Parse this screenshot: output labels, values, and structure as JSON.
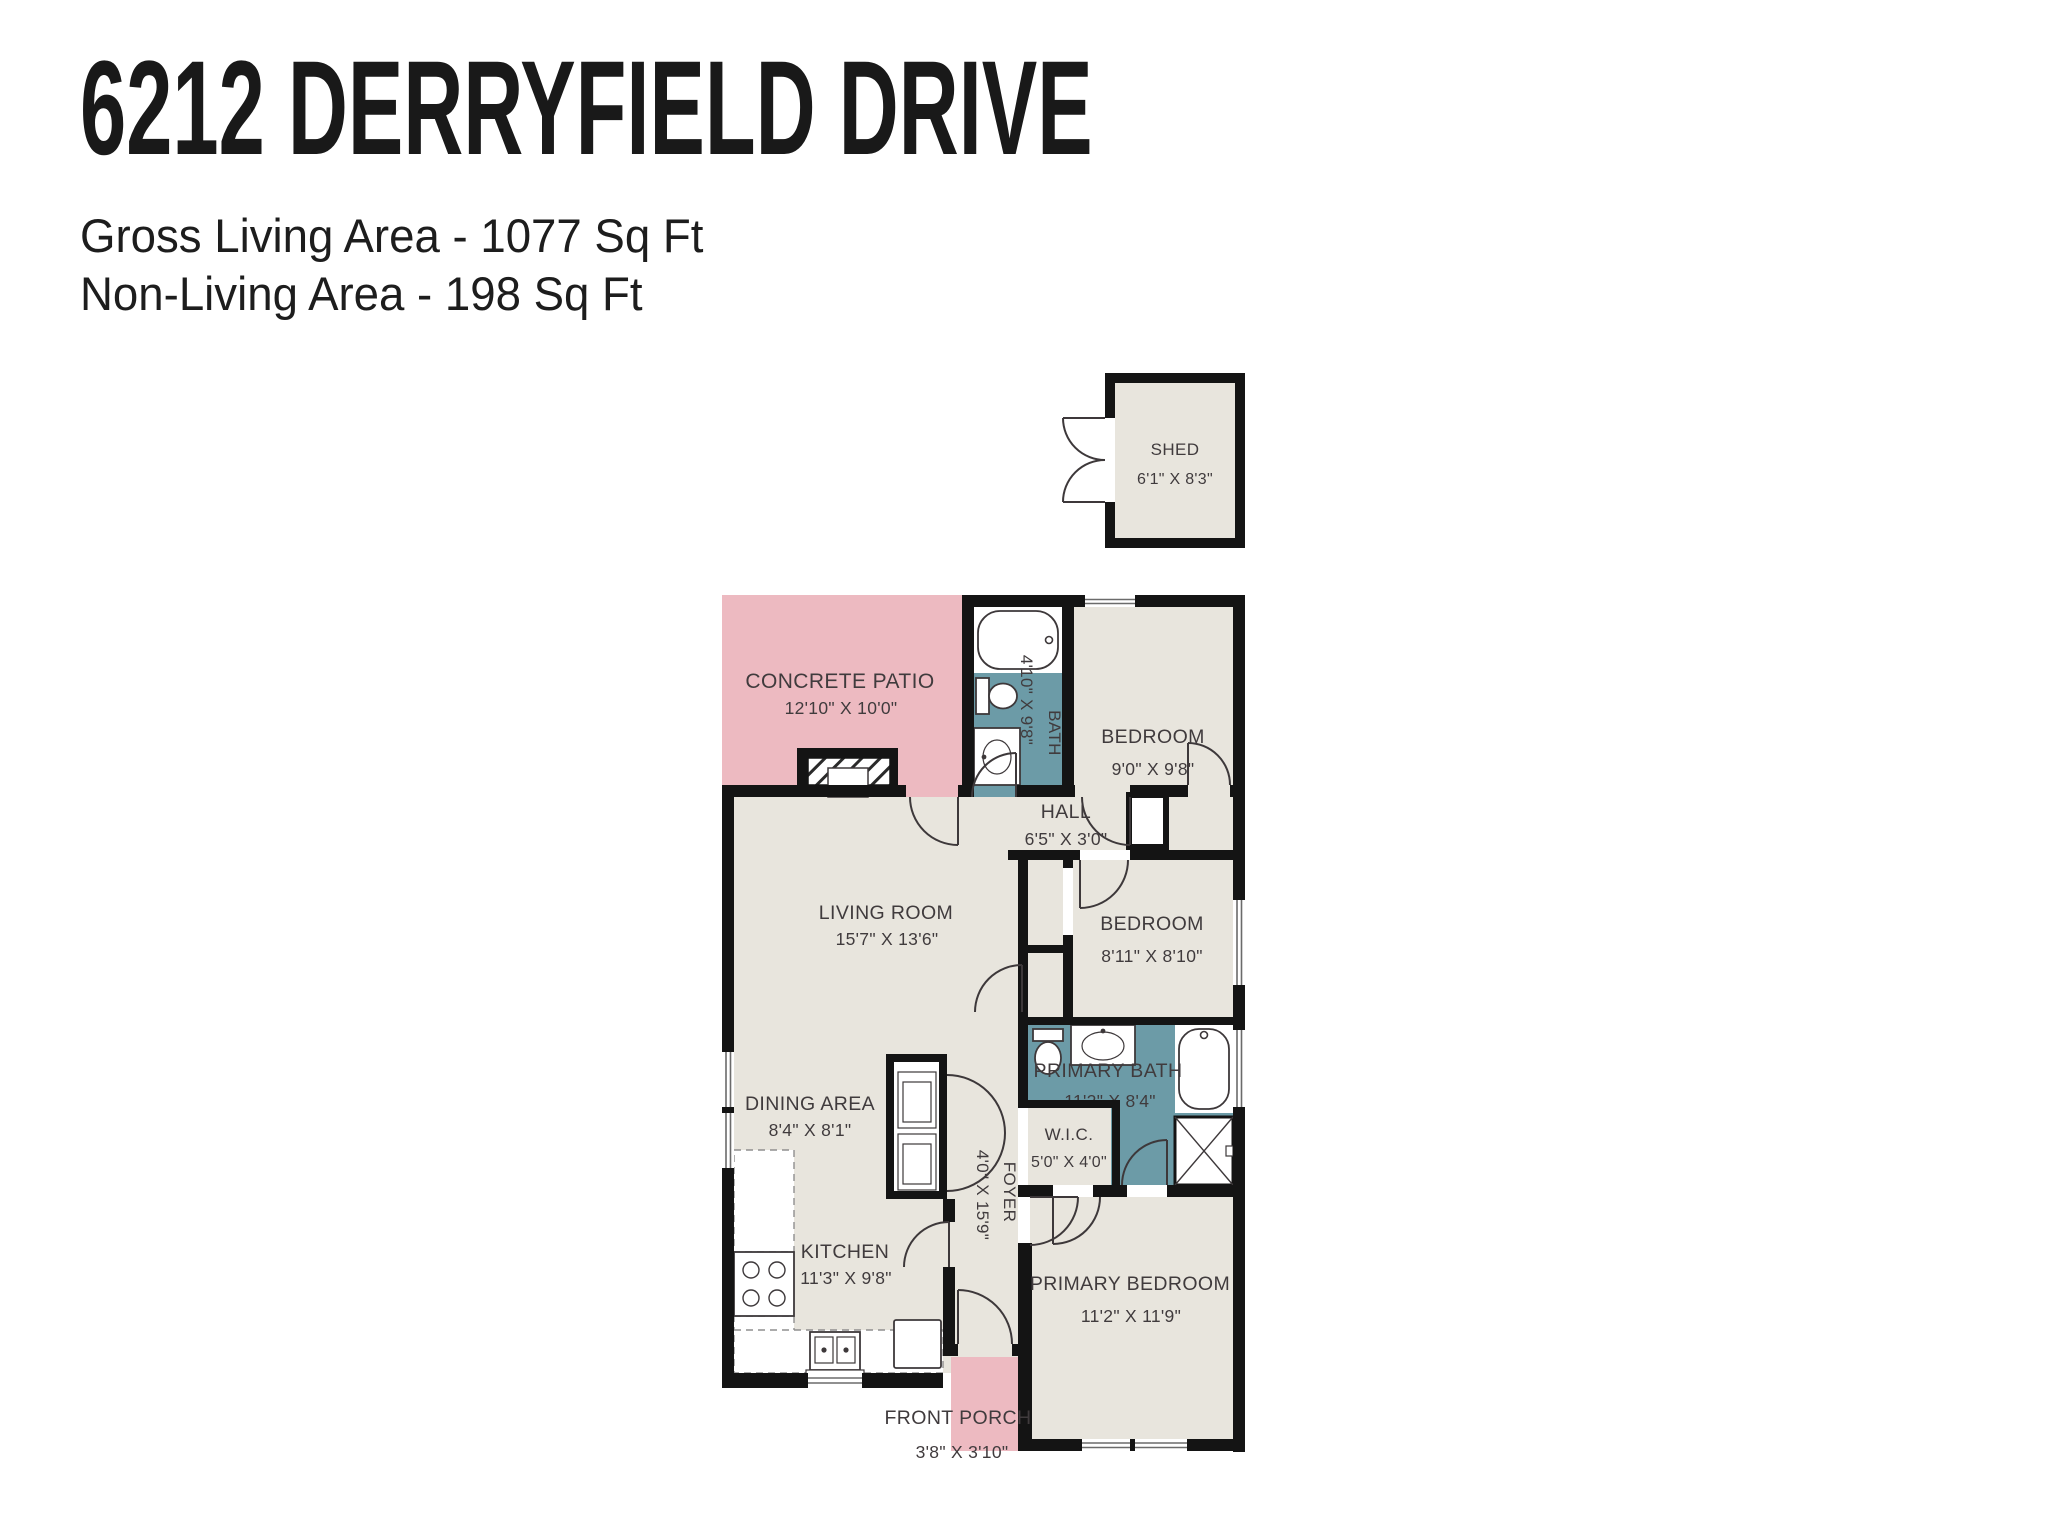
{
  "header": {
    "title": "6212 DERRYFIELD DRIVE",
    "subtitle1": "Gross Living Area - 1077 Sq Ft",
    "subtitle2": "Non-Living Area - 198 Sq Ft"
  },
  "colors": {
    "wall": "#141414",
    "room_fill": "#e8e5dd",
    "outdoor_pink": "#edbac1",
    "bath_teal": "#6c9ba7",
    "label_text": "#403b3d",
    "background": "#ffffff"
  },
  "rooms": {
    "shed": {
      "name": "SHED",
      "dims": "6'1\" X 8'3\""
    },
    "patio": {
      "name": "CONCRETE PATIO",
      "dims": "12'10\" X 10'0\""
    },
    "bath": {
      "name": "BATH",
      "dims": "4'10\" X 9'8\""
    },
    "bedroom1": {
      "name": "BEDROOM",
      "dims": "9'0\" X 9'8\""
    },
    "hall": {
      "name": "HALL",
      "dims": "6'5\" X 3'0\""
    },
    "living": {
      "name": "LIVING ROOM",
      "dims": "15'7\" X 13'6\""
    },
    "bedroom2": {
      "name": "BEDROOM",
      "dims": "8'11\" X 8'10\""
    },
    "primary_bath": {
      "name": "PRIMARY BATH",
      "dims": "11'2\" X 8'4\""
    },
    "dining": {
      "name": "DINING AREA",
      "dims": "8'4\" X 8'1\""
    },
    "wic": {
      "name": "W.I.C.",
      "dims": "5'0\" X 4'0\""
    },
    "foyer": {
      "name": "FOYER",
      "dims": "4'0\" X 15'9\""
    },
    "kitchen": {
      "name": "KITCHEN",
      "dims": "11'3\" X 9'8\""
    },
    "primary_bedroom": {
      "name": "PRIMARY BEDROOM",
      "dims": "11'2\" X 11'9\""
    },
    "porch": {
      "name": "FRONT PORCH",
      "dims": "3'8\" X 3'10\""
    }
  }
}
